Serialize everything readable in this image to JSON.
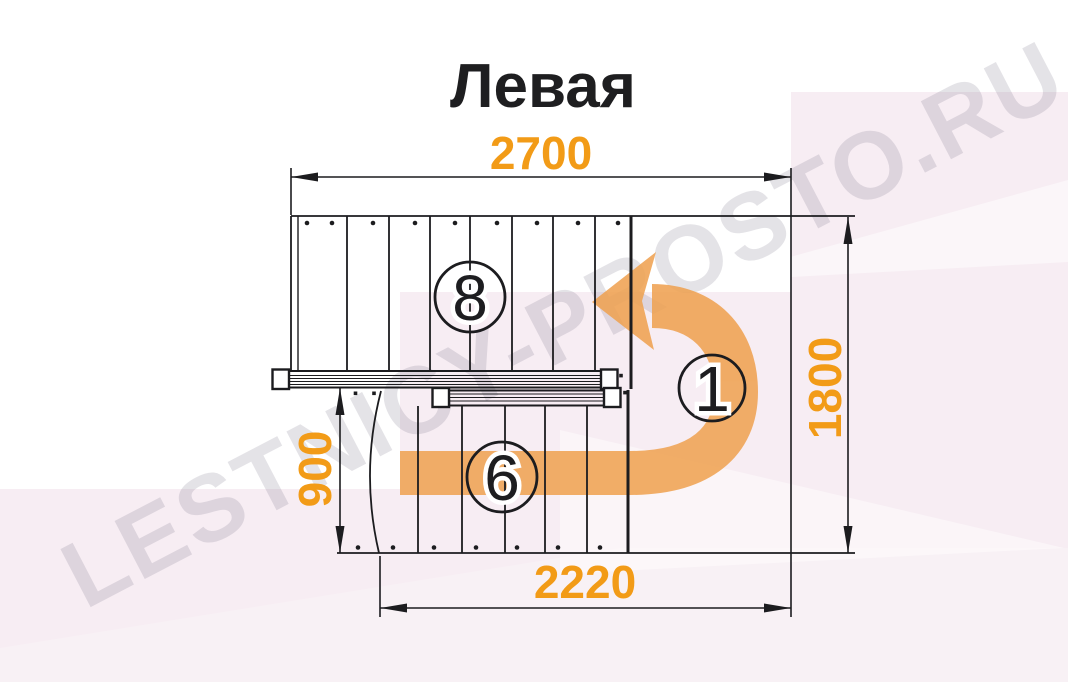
{
  "title": "Левая",
  "watermark": {
    "text": "LESTNICY-PROSTO.RU"
  },
  "dimensions": {
    "top_width": "2700",
    "right_depth": "1800",
    "left_flight_length": "900",
    "bottom_width": "2220"
  },
  "step_labels": {
    "upper_flight": "8",
    "turn": "1",
    "lower_flight": "6"
  },
  "colors": {
    "dimension_orange": "#F29B17",
    "arrow_orange": "#EFA251",
    "line_black": "#1c1c1f",
    "background_pink": "#F7EDF3",
    "watermark_gray": "#6b6478"
  }
}
